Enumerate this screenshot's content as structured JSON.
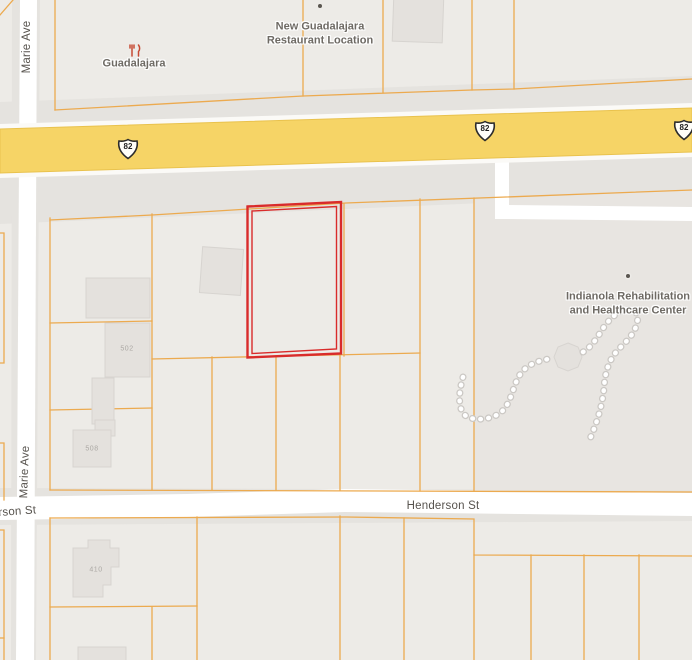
{
  "map": {
    "street_labels": {
      "marie_ave": "Marie Ave",
      "henderson": "Henderson St",
      "henderson_partial": "rson St"
    },
    "highway_shields": [
      {
        "route": "82"
      },
      {
        "route": "82"
      },
      {
        "route": "82"
      }
    ],
    "pois": [
      {
        "name": "Guadalajara",
        "icon": "restaurant-icon"
      },
      {
        "name": "New Guadalajara Restaurant Location",
        "icon": "poi-dot"
      },
      {
        "name": "Indianola Rehabilitation and Healthcare Center",
        "icon": "poi-dot"
      }
    ],
    "house_numbers": [
      "502",
      "508",
      "410"
    ],
    "colors": {
      "background": "#edebe7",
      "road_corridor": "#e5e3df",
      "healthcare_grounds": "#e8e5e1",
      "road_fill": "#ffffff",
      "highway_fill": "#f6d466",
      "highway_edge": "#e9c24d",
      "parcel_line": "#ecaa4f",
      "selected_parcel_outline": "#d92b2b",
      "building_fill": "#e4e1dd",
      "building_edge": "#d7d4d0",
      "street_label": "#57534e",
      "poi_label": "#6e6a64",
      "house_number": "#aba8a4",
      "restaurant_icon": "#c64a33",
      "path_dots": "#ffffff",
      "path_dot_edge": "#cbc8c4"
    }
  }
}
